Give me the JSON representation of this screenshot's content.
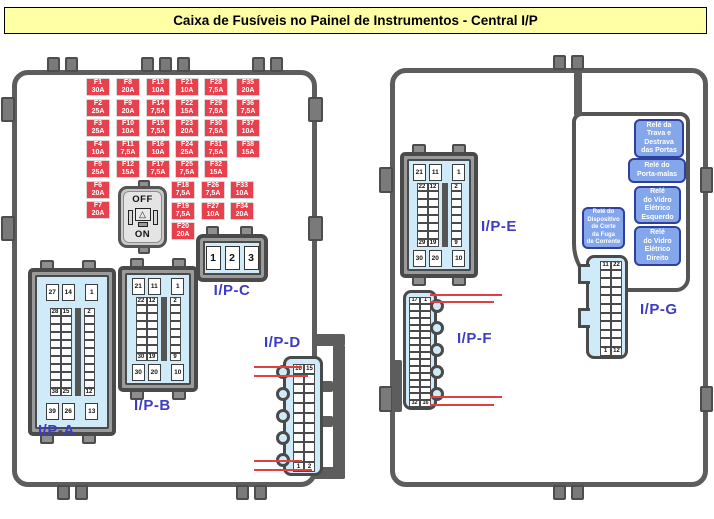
{
  "title": "Caixa de Fusíveis no Painel de Instrumentos - Central I/P",
  "switch": {
    "off_label": "OFF",
    "on_label": "ON"
  },
  "fuse_box": {
    "groups": [
      {
        "id": "col1",
        "fuses": [
          {
            "name": "F1",
            "amp": "30A"
          },
          {
            "name": "F2",
            "amp": "25A"
          },
          {
            "name": "F3",
            "amp": "25A"
          },
          {
            "name": "F4",
            "amp": "10A"
          },
          {
            "name": "F5",
            "amp": "25A"
          },
          {
            "name": "F6",
            "amp": "20A"
          },
          {
            "name": "F7",
            "amp": "20A"
          }
        ]
      },
      {
        "id": "col2",
        "fuses": [
          {
            "name": "F8",
            "amp": "20A"
          },
          {
            "name": "F9",
            "amp": "20A"
          },
          {
            "name": "F10",
            "amp": "10A"
          },
          {
            "name": "F11",
            "amp": "7,5A"
          },
          {
            "name": "F12",
            "amp": "15A"
          }
        ]
      },
      {
        "id": "col3",
        "fuses": [
          {
            "name": "F13",
            "amp": "10A"
          },
          {
            "name": "F14",
            "amp": "7,5A"
          },
          {
            "name": "F15",
            "amp": "7,5A"
          },
          {
            "name": "F16",
            "amp": "10A"
          },
          {
            "name": "F17",
            "amp": "7,5A"
          }
        ]
      },
      {
        "id": "col4",
        "fuses": [
          {
            "name": "F21",
            "amp": "10A"
          },
          {
            "name": "F22",
            "amp": "15A"
          },
          {
            "name": "F23",
            "amp": "20A"
          },
          {
            "name": "F24",
            "amp": "25A"
          },
          {
            "name": "F25",
            "amp": "7,5A"
          }
        ]
      },
      {
        "id": "col5",
        "fuses": [
          {
            "name": "F28",
            "amp": "7,5A"
          },
          {
            "name": "F29",
            "amp": "7,5A"
          },
          {
            "name": "F30",
            "amp": "7,5A"
          },
          {
            "name": "F31",
            "amp": "7,5A"
          },
          {
            "name": "F32",
            "amp": "15A"
          }
        ]
      },
      {
        "id": "col6",
        "fuses": [
          {
            "name": "F35",
            "amp": "20A"
          },
          {
            "name": "F36",
            "amp": "7,5A"
          },
          {
            "name": "F37",
            "amp": "10A"
          },
          {
            "name": "F38",
            "amp": "15A"
          }
        ]
      },
      {
        "id": "col4b",
        "fuses": [
          {
            "name": "F18",
            "amp": "7,5A"
          },
          {
            "name": "F19",
            "amp": "7,5A"
          },
          {
            "name": "F20",
            "amp": "20A"
          }
        ]
      },
      {
        "id": "col5b",
        "fuses": [
          {
            "name": "F26",
            "amp": "7,5A"
          },
          {
            "name": "F27",
            "amp": "10A"
          }
        ]
      },
      {
        "id": "col6b",
        "fuses": [
          {
            "name": "F33",
            "amp": "10A"
          },
          {
            "name": "F34",
            "amp": "20A"
          }
        ]
      }
    ]
  },
  "connectors": {
    "ip_a": {
      "label": "I/P-A",
      "top": [
        "27",
        "14",
        "1"
      ],
      "grid_rows": 11,
      "grid_first": [
        "28",
        "15",
        "2"
      ],
      "grid_last": [
        "38",
        "25",
        "12"
      ],
      "bottom": [
        "39",
        "26",
        "13"
      ]
    },
    "ip_b": {
      "label": "I/P-B",
      "top": [
        "21",
        "11",
        "1"
      ],
      "grid_rows": 8,
      "grid_first": [
        "22",
        "12",
        "2"
      ],
      "grid_last": [
        "30",
        "19",
        "9"
      ],
      "bottom": [
        "30",
        "20",
        "10"
      ]
    },
    "ip_c": {
      "label": "I/P-C",
      "cells": [
        "1",
        "2",
        "3"
      ]
    },
    "ip_d": {
      "label": "I/P-D",
      "rows": 11,
      "top": [
        "16",
        "15"
      ],
      "bottom": [
        "1",
        "2"
      ]
    },
    "ip_e": {
      "label": "I/P-E",
      "top": [
        "21",
        "11",
        "1"
      ],
      "grid_rows": 8,
      "grid_first": [
        "22",
        "12",
        "2"
      ],
      "grid_last": [
        "29",
        "19",
        "9"
      ],
      "bottom": [
        "30",
        "20",
        "10"
      ]
    },
    "ip_f": {
      "label": "I/P-F",
      "rows": 16,
      "top": [
        "17",
        "1"
      ],
      "bottom": [
        "32",
        "16"
      ]
    },
    "ip_g": {
      "label": "I/P-G",
      "rows": 11,
      "top": [
        "11",
        "22"
      ],
      "bottom": [
        "1",
        "12"
      ]
    }
  },
  "relays": [
    {
      "id": "trava",
      "lines": [
        "Relé da",
        "Trava e",
        "Destrava",
        "das Portas"
      ]
    },
    {
      "id": "porta_malas",
      "lines": [
        "Relé do",
        "Porta-malas"
      ]
    },
    {
      "id": "vidro_esq",
      "lines": [
        "Relé",
        "do Vidro",
        "Elétrico",
        "Esquerdo"
      ]
    },
    {
      "id": "dispositivo",
      "lines": [
        "Relé do",
        "Dispositivo",
        "de Corte",
        "da Fuga",
        "de Corrente"
      ]
    },
    {
      "id": "vidro_dir",
      "lines": [
        "Relé",
        "do Vidro",
        "Elétrico",
        "Direito"
      ]
    }
  ],
  "colors": {
    "fuse_red": "#e8414e",
    "connector_blue": "#cfeaf8",
    "relay_blue": "#84a6ea",
    "relay_border": "#2e3f9e",
    "label_blue": "#3c3cc4",
    "panel_gray": "#5d5d5d",
    "leader_red": "#e04040",
    "title_yellow": "#ffffa6"
  }
}
